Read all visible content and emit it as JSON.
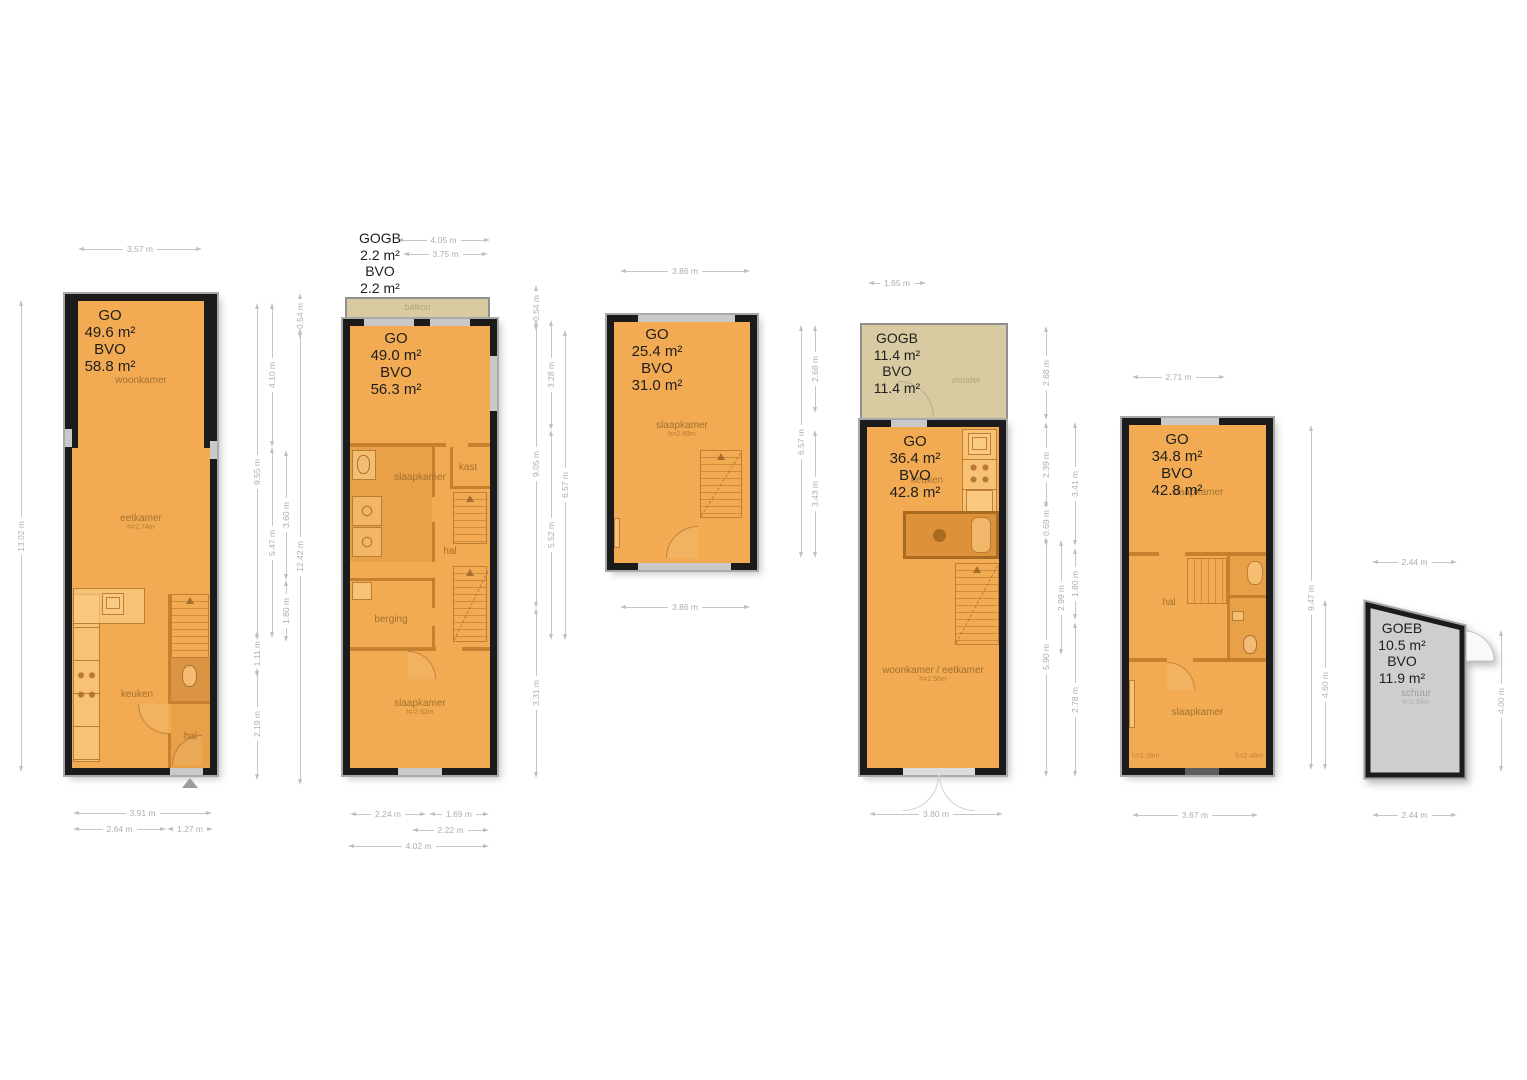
{
  "colors": {
    "floor": "#f2ab53",
    "wall": "#1b1b1b",
    "balcony_tan": "#d8cba2",
    "shed_gray": "#cecece",
    "dimension_gray": "#b5b5b5",
    "room_label": "#a9762e",
    "area_label": "#1e1e1e"
  },
  "plans": [
    {
      "area": [
        "GO",
        "49.6 m²",
        "BVO",
        "58.8 m²"
      ],
      "rooms": {
        "woonkamer": "woonkamer",
        "eetkamer": "eetkamer",
        "eetkamer_h": "h=2.74m",
        "keuken": "keuken",
        "hal": "hal"
      },
      "dims": {
        "top": "3.57 m",
        "left": "13.02 m",
        "r1a": "9.55 m",
        "r1b": "1.11 m",
        "r1c": "2.19 m",
        "r2a": "4.10 m",
        "r2b": "5.47 m",
        "r3a": "3.60 m",
        "r3b": "1.80 m",
        "r4a": "0.54 m",
        "r4b": "12.42 m",
        "b1": "3.91 m",
        "b2": "2.64 m",
        "b3": "1.27 m"
      }
    },
    {
      "gogb": [
        "GOGB",
        "2.2 m²",
        "BVO",
        "2.2 m²"
      ],
      "area": [
        "GO",
        "49.0 m²",
        "BVO",
        "56.3 m²"
      ],
      "rooms": {
        "balkon": "balkon",
        "slaapkamer_boven": "slaapkamer",
        "kast": "kast",
        "hal": "hal",
        "berging": "berging",
        "slaapkamer": "slaapkamer",
        "slaapkamer_h": "h=2.62m"
      },
      "dims": {
        "t1": "4.05 m",
        "t2": "3.75 m",
        "r1a": "0.54 m",
        "r1b": "9.05 m",
        "r1c": "3.31 m",
        "r2a": "3.28 m",
        "r2b": "5.52 m",
        "r3": "6.57 m",
        "b1": "2.24 m",
        "b2": "1.69 m",
        "b3": "2.22 m",
        "b4": "4.02 m"
      }
    },
    {
      "area": [
        "GO",
        "25.4 m²",
        "BVO",
        "31.0 m²"
      ],
      "rooms": {
        "slaapkamer": "slaapkamer",
        "slaapkamer_h": "h=2.49m"
      },
      "dims": {
        "top": "3.86 m",
        "r1": "6.57 m",
        "r2a": "2.68 m",
        "r2b": "3.43 m",
        "bottom": "3.86 m"
      }
    },
    {
      "gogb": [
        "GOGB",
        "11.4 m²",
        "BVO",
        "11.4 m²"
      ],
      "area": [
        "GO",
        "36.4 m²",
        "BVO",
        "42.8 m²"
      ],
      "rooms": {
        "vlonder": "vlonder",
        "keuken": "keuken",
        "woonkamer": "woonkamer / eetkamer",
        "woonkamer_h": "h=2.56m"
      },
      "dims": {
        "top": "1.65 m",
        "r1a": "2.68 m",
        "r1b": "2.39 m",
        "r1c": "0.69 m",
        "r1d": "5.90 m",
        "r2": "2.99 m",
        "r3a": "3.41 m",
        "r3b": "1.80 m",
        "r3c": "2.78 m",
        "bottom": "3.80 m"
      }
    },
    {
      "area": [
        "GO",
        "34.8 m²",
        "BVO",
        "42.8 m²"
      ],
      "rooms": {
        "slaapkamer_boven": "slaapkamer",
        "hal": "hal",
        "slaapkamer": "slaapkamer",
        "h_links": "h=1.98m",
        "h_rechts": "h=2.48m"
      },
      "dims": {
        "top": "2.71 m",
        "r1": "9.47 m",
        "r2": "4.60 m",
        "bottom": "3.67 m"
      }
    },
    {
      "area": [
        "GOEB",
        "10.5 m²",
        "BVO",
        "11.9 m²"
      ],
      "rooms": {
        "schuur": "schuur",
        "schuur_h": "h=2.54m"
      },
      "dims": {
        "top": "2.44 m",
        "right": "4.00 m",
        "bottom": "2.44 m"
      }
    }
  ]
}
